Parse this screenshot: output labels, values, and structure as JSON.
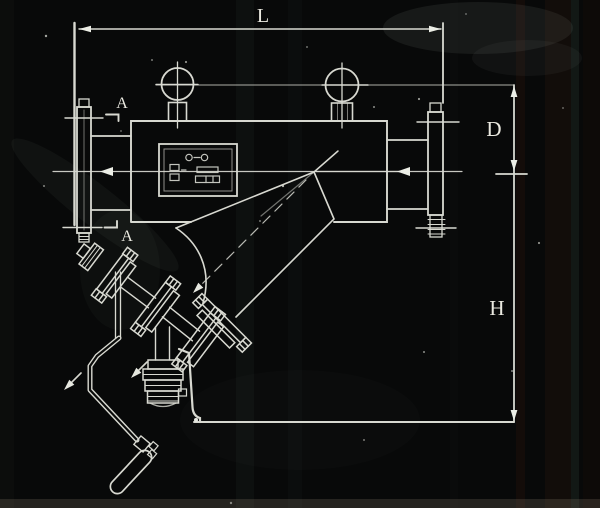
{
  "drawing": {
    "type": "engineering dimension drawing (photographed print)",
    "subject": "Y-type backwash strainer / filter, side elevation with drain valve and crank handle",
    "labels": {
      "dim_length": "L",
      "dim_diameter": "D",
      "dim_height": "H",
      "section_cut_top": "A",
      "section_cut_bottom": "A"
    },
    "colors": {
      "background": "#080909",
      "line": "#d8d9d1",
      "bright_line": "#eceee6",
      "accent_cyan": "#a8c4b4",
      "text": "#eae9e0"
    }
  }
}
